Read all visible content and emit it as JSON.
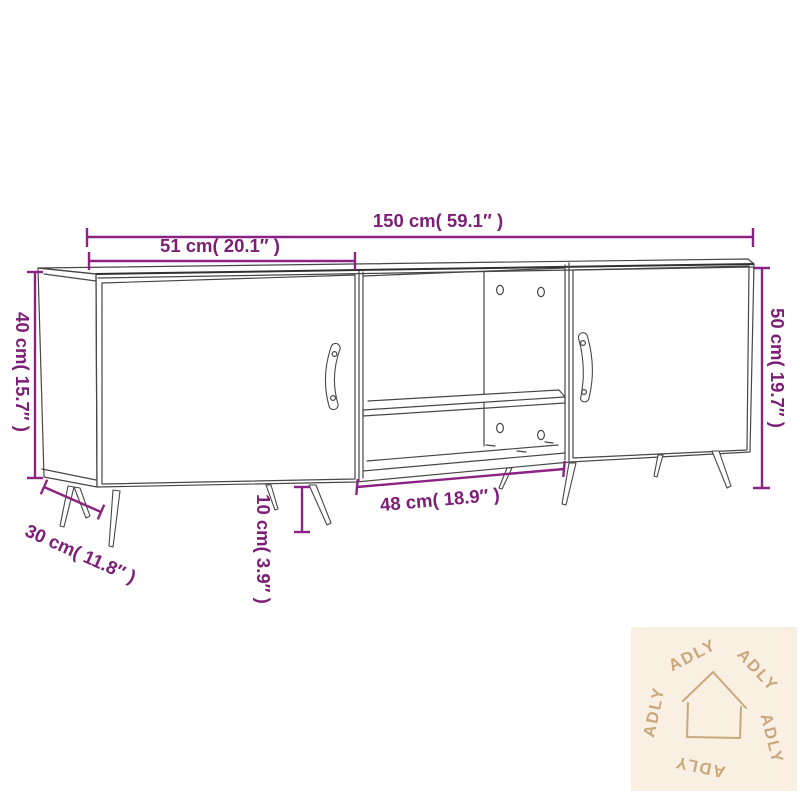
{
  "product": {
    "type": "tv-cabinet-line-drawing",
    "sections": [
      "left-door",
      "open-shelf-compartment",
      "right-door"
    ]
  },
  "dimensions": {
    "total_width": {
      "label": "150 cm( 59.1″ )",
      "cm": 150,
      "inch": 59.1
    },
    "left_width": {
      "label": "51 cm( 20.1″ )",
      "cm": 51,
      "inch": 20.1
    },
    "left_height": {
      "label": "40 cm( 15.7″ )",
      "cm": 40,
      "inch": 15.7
    },
    "right_height": {
      "label": "50 cm( 19.7″ )",
      "cm": 50,
      "inch": 19.7
    },
    "depth": {
      "label": "30 cm( 11.8″ )",
      "cm": 30,
      "inch": 11.8
    },
    "leg_height": {
      "label": "10 cm( 3.9″ )",
      "cm": 10,
      "inch": 3.9
    },
    "middle_width": {
      "label": "48 cm( 18.9″ )",
      "cm": 48,
      "inch": 18.9
    }
  },
  "watermark": {
    "brand": "ADLY",
    "icon": "house-outline-icon",
    "repeat": 5
  },
  "colors": {
    "dimension_line": "#8c2383",
    "dimension_text": "#7c1d76",
    "drawing_line": "#474747",
    "watermark_bg": "#f9efe3",
    "watermark_fg": "#c9a87c",
    "background": "#ffffff"
  }
}
